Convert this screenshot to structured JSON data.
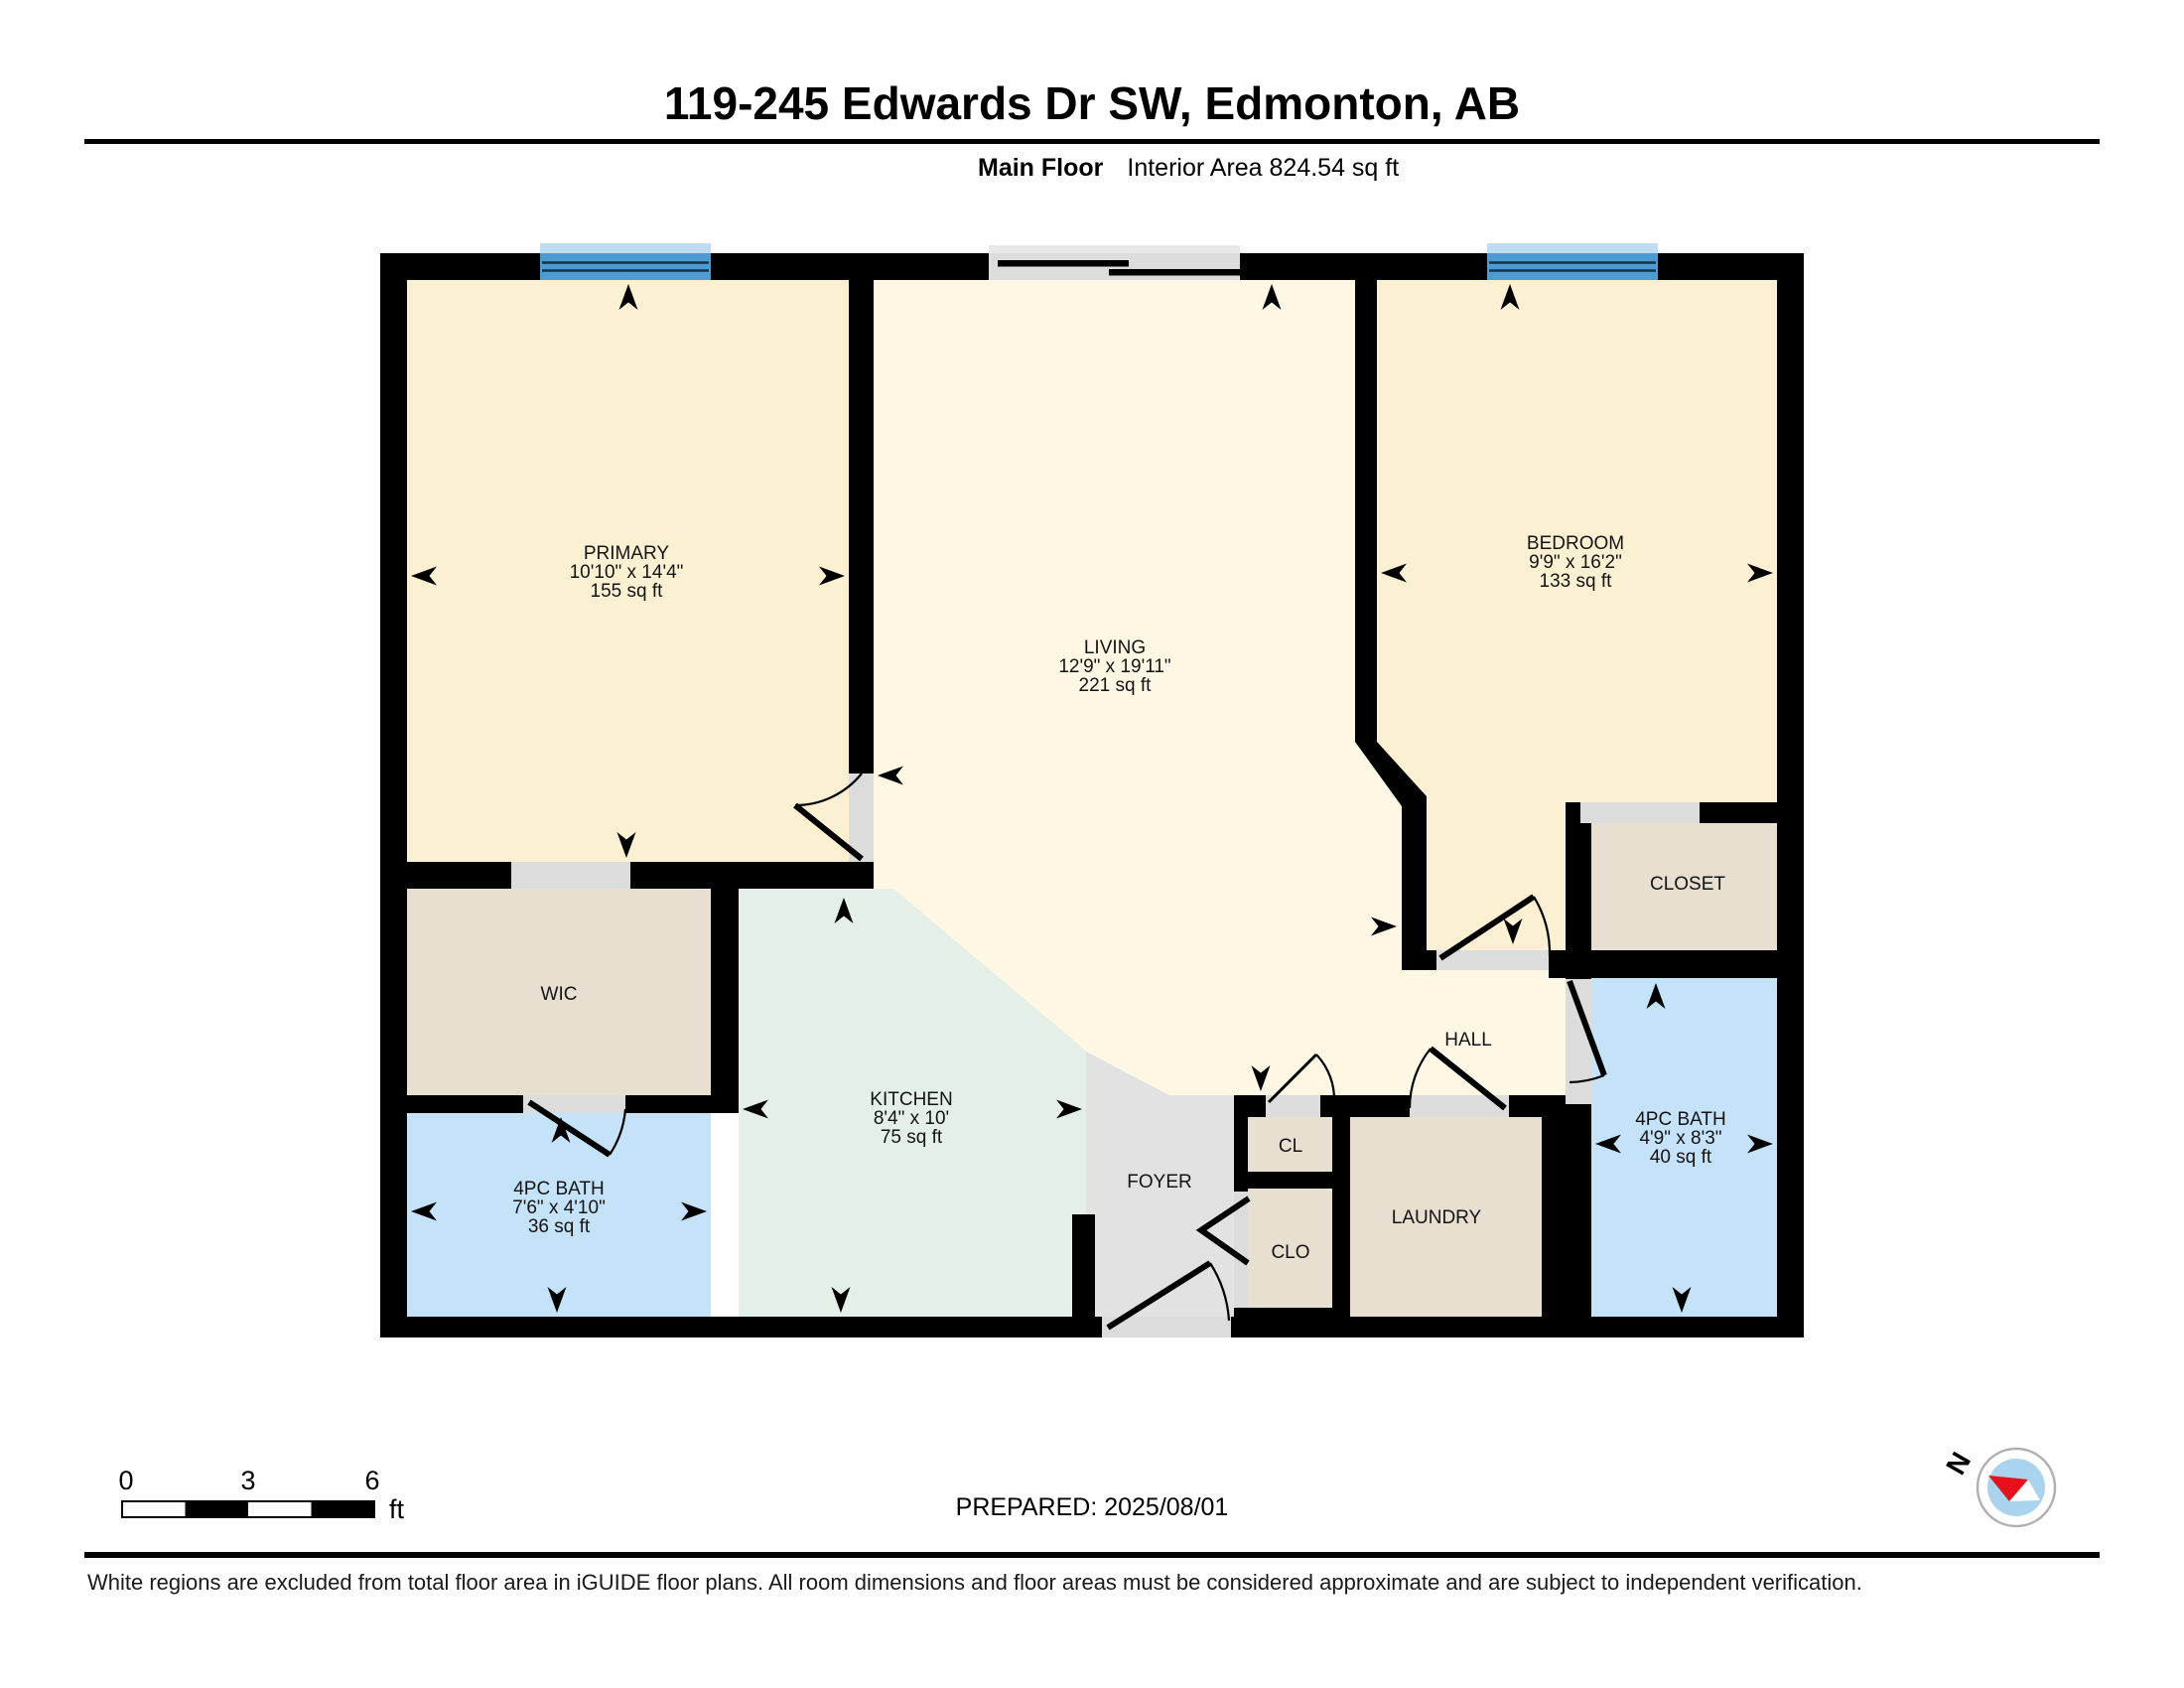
{
  "header": {
    "title": "119-245 Edwards Dr SW, Edmonton, AB",
    "floor_label": "Main Floor",
    "interior_area": "Interior Area 824.54 sq ft"
  },
  "rooms": {
    "primary": {
      "name": "PRIMARY",
      "dims": "10'10\" x 14'4\"",
      "area": "155 sq ft"
    },
    "living": {
      "name": "LIVING",
      "dims": "12'9\" x 19'11\"",
      "area": "221 sq ft"
    },
    "bedroom": {
      "name": "BEDROOM",
      "dims": "9'9\" x 16'2\"",
      "area": "133 sq ft"
    },
    "kitchen": {
      "name": "KITCHEN",
      "dims": "8'4\" x 10'",
      "area": "75 sq ft"
    },
    "bath_left": {
      "name": "4PC BATH",
      "dims": "7'6\" x 4'10\"",
      "area": "36 sq ft"
    },
    "bath_right": {
      "name": "4PC BATH",
      "dims": "4'9\" x 8'3\"",
      "area": "40 sq ft"
    },
    "wic": {
      "name": "WIC"
    },
    "closet": {
      "name": "CLOSET"
    },
    "hall": {
      "name": "HALL"
    },
    "foyer": {
      "name": "FOYER"
    },
    "cl": {
      "name": "CL"
    },
    "clo": {
      "name": "CLO"
    },
    "laundry": {
      "name": "LAUNDRY"
    }
  },
  "scale_bar": {
    "t0": "0",
    "t3": "3",
    "t6": "6",
    "unit": "ft"
  },
  "footer": {
    "prepared": "PREPARED: 2025/08/01",
    "disclaimer": "White regions are excluded from total floor area in iGUIDE floor plans. All room dimensions and floor areas must be considered approximate and are subject to independent verification."
  },
  "compass": {
    "north": "N"
  },
  "colors": {
    "wall": "#000000",
    "room_warm": "#FBF0D2",
    "room_light": "#FDF7E4",
    "kitchen": "#E4EFE7",
    "bath": "#C4E3F8",
    "storage": "#E7DFCF",
    "foyer": "#E2E2E2",
    "opening": "#DCDCDC",
    "window": "#4D9BD3",
    "window_sill": "#BFDDF2",
    "slider_sill": "#E8E8E8",
    "compass_inner": "#A9D3EE",
    "compass_red": "#E8101B"
  }
}
